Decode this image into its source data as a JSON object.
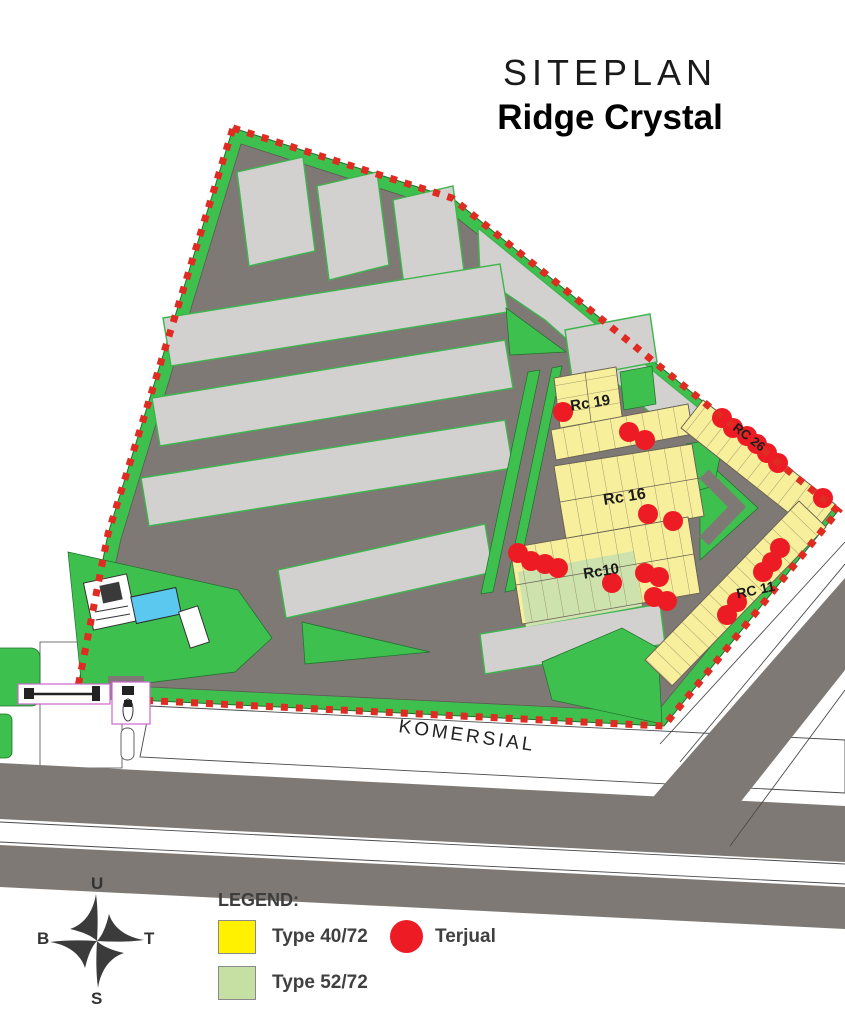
{
  "title": {
    "line1": "SITEPLAN",
    "line2": "Ridge Crystal"
  },
  "map": {
    "road_label": "KOMERSIAL",
    "blocks": [
      {
        "id": "rc19",
        "label": "Rc 19"
      },
      {
        "id": "rc16",
        "label": "Rc 16"
      },
      {
        "id": "rc10",
        "label": "Rc10"
      },
      {
        "id": "rc26",
        "label": "RC 26"
      },
      {
        "id": "rc11",
        "label": "RC 11"
      }
    ],
    "sold_markers": [
      [
        563,
        412
      ],
      [
        629,
        432
      ],
      [
        645,
        440
      ],
      [
        648,
        514
      ],
      [
        673,
        521
      ],
      [
        518,
        553
      ],
      [
        531,
        561
      ],
      [
        545,
        564
      ],
      [
        558,
        568
      ],
      [
        612,
        583
      ],
      [
        645,
        573
      ],
      [
        659,
        577
      ],
      [
        654,
        597
      ],
      [
        667,
        601
      ],
      [
        722,
        418
      ],
      [
        733,
        428
      ],
      [
        747,
        436
      ],
      [
        757,
        444
      ],
      [
        767,
        453
      ],
      [
        778,
        463
      ],
      [
        823,
        498
      ],
      [
        780,
        548
      ],
      [
        772,
        562
      ],
      [
        763,
        572
      ],
      [
        737,
        602
      ],
      [
        727,
        615
      ]
    ],
    "colors": {
      "lot_type_40": "#F7EF9B",
      "lot_type_52": "#CDE2AD",
      "green": "#3EC04E",
      "road": "#7E7974",
      "block": "#D2D1CF",
      "boundary": "#DF2B21",
      "sold": "#ED1C24",
      "pool": "#5BC8F0",
      "gate": "#CC66CC"
    }
  },
  "compass": {
    "north": "U",
    "east": "T",
    "south": "S",
    "west": "B"
  },
  "legend": {
    "heading": "LEGEND:",
    "items": [
      {
        "label": "Type 40/72",
        "swatch": "square",
        "color": "#FFF100"
      },
      {
        "label": "Type 52/72",
        "swatch": "square",
        "color": "#C6DFA2"
      },
      {
        "label": "Terjual",
        "swatch": "circle",
        "color": "#ED1C24"
      }
    ]
  }
}
